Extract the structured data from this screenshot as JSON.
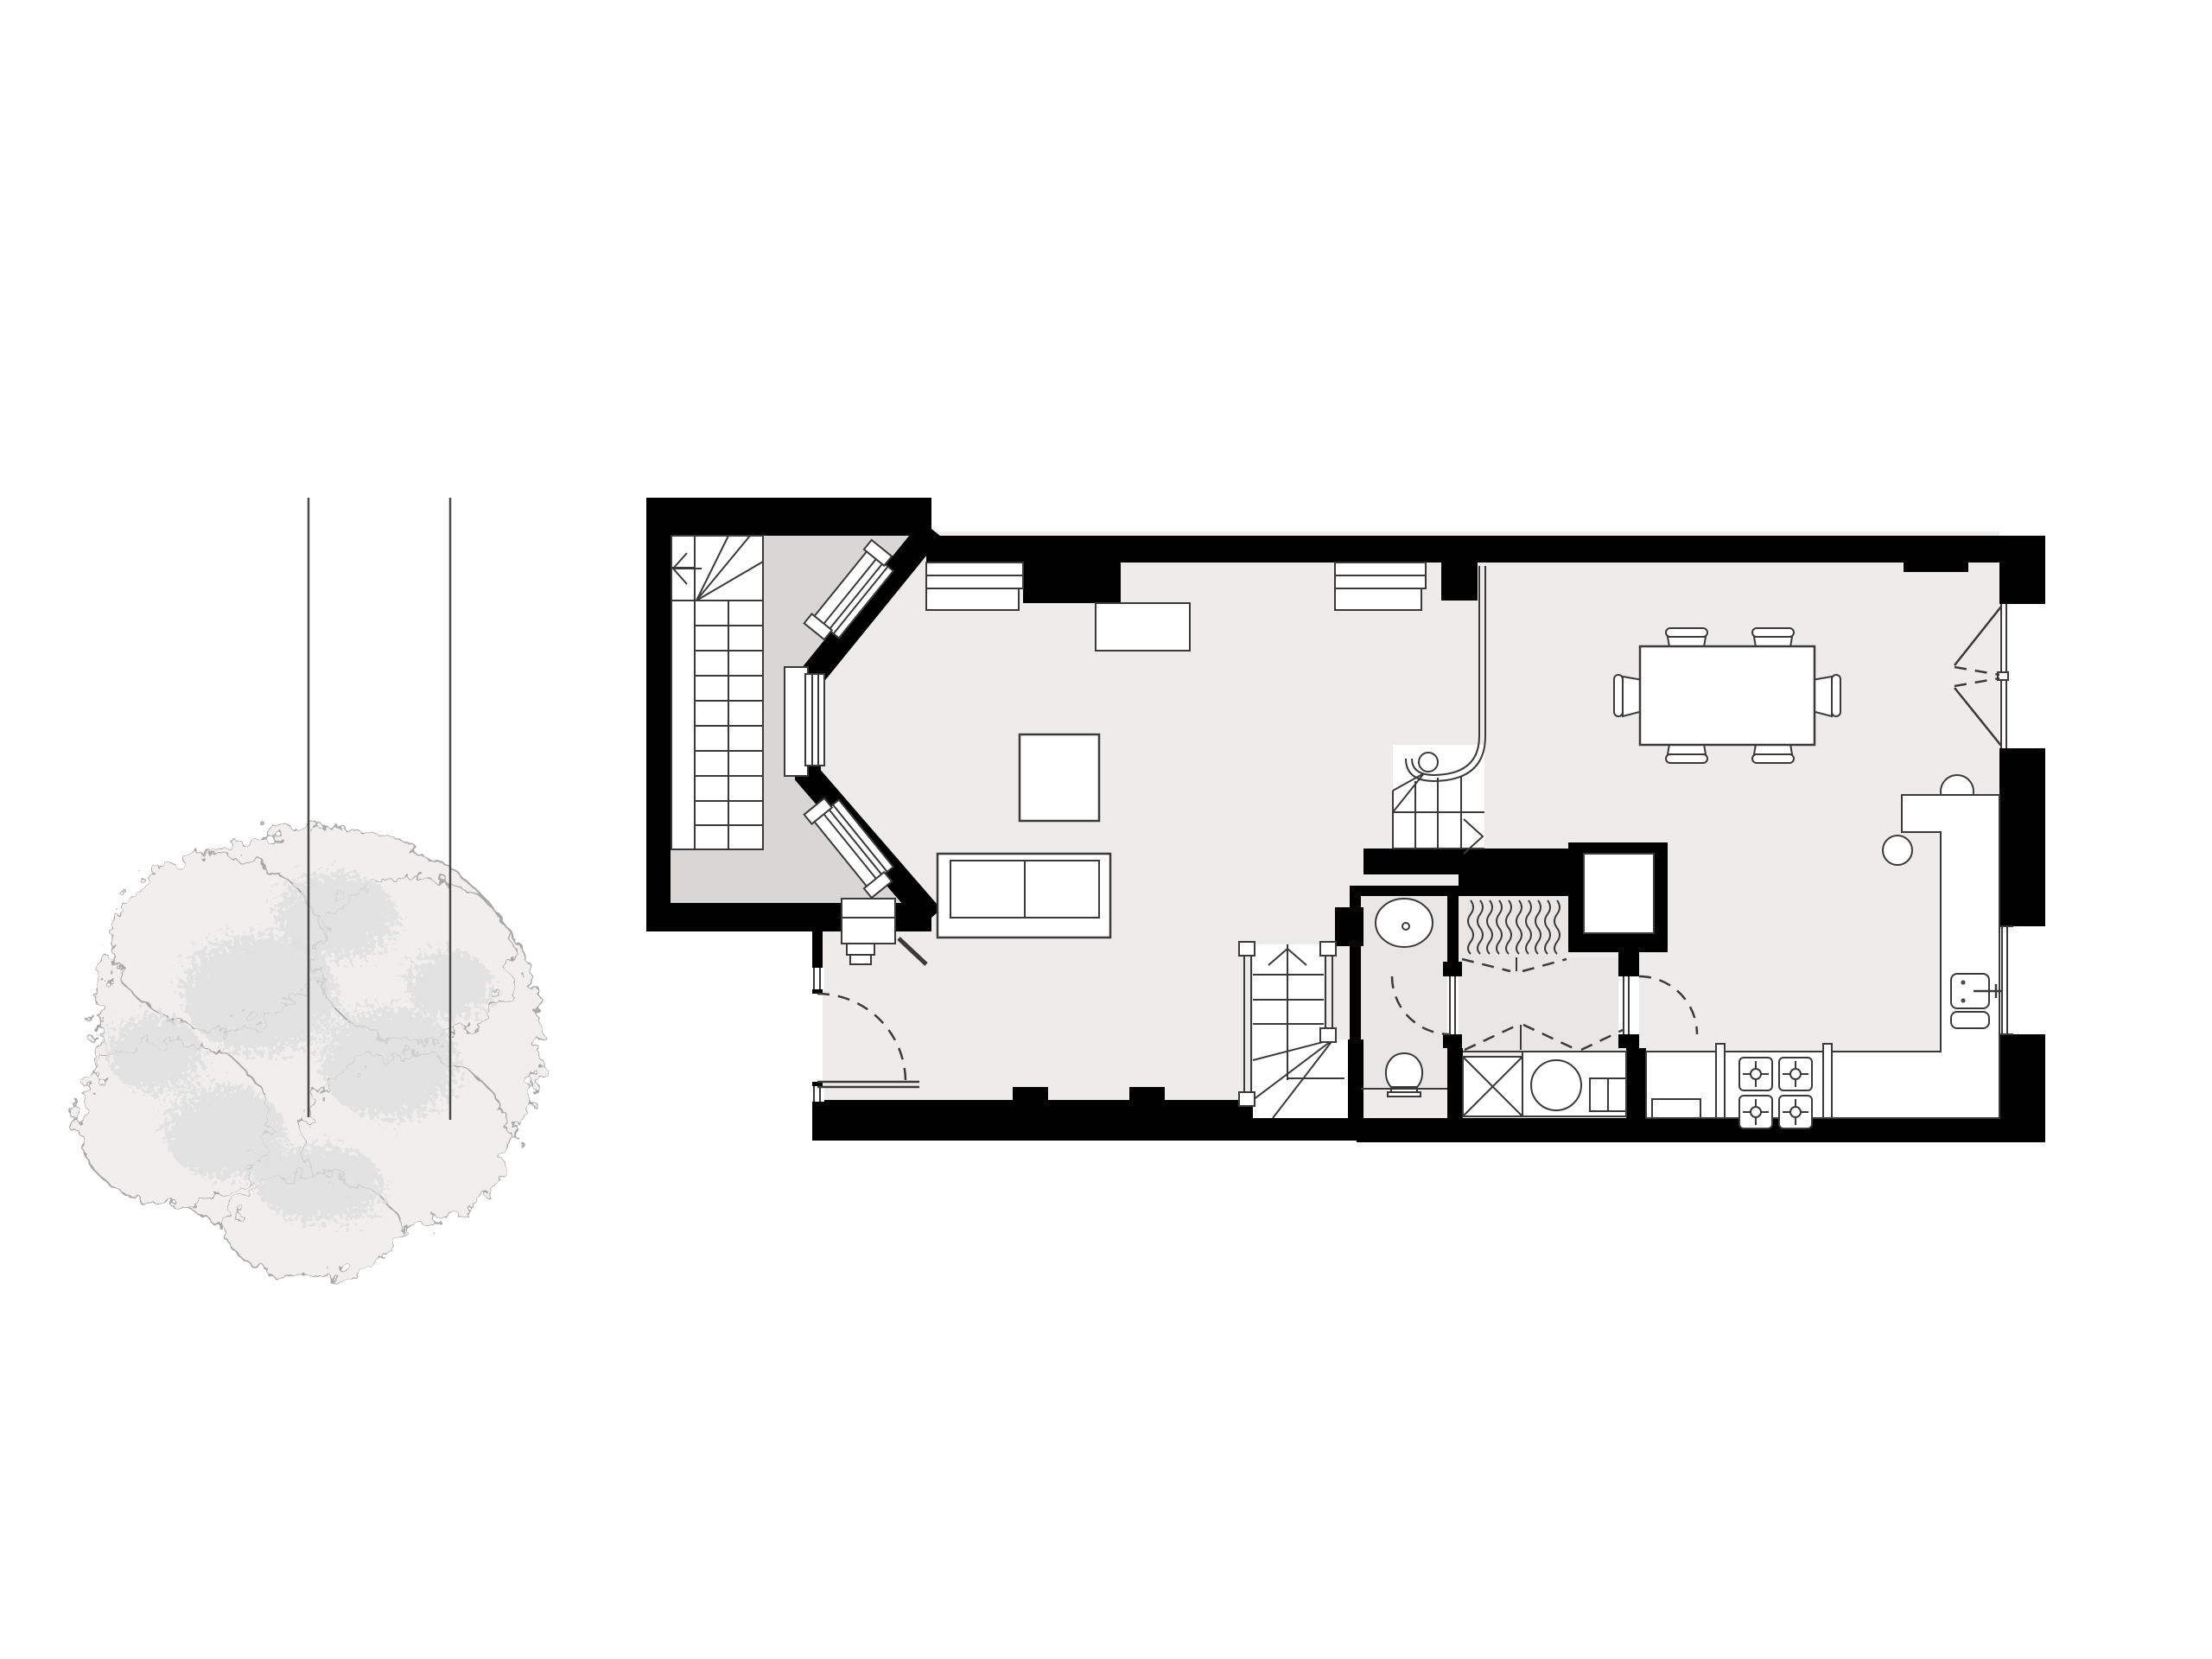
{
  "document": {
    "type": "architectural-floor-plan",
    "level": "ground floor",
    "drawing_style": "black poche walls, white fixtures, gray floor tints",
    "visible_text": "none"
  },
  "colors": {
    "wall": "#000000",
    "line": "#3a3a3a",
    "floor_main": "#edecea",
    "floor_hall": "#d8d7d5",
    "floor_wet": "#e8e7e5",
    "white": "#ffffff",
    "tree_fill": "#f0efee",
    "tree_edge": "#a9a9a9",
    "tree_mottle": "#dededd",
    "boundary": "#4a4a4a",
    "bg": "#ffffff"
  },
  "site": {
    "tree": {
      "shape": "plan-view canopy blob",
      "position": "left of plan",
      "texture": "mottled light gray"
    },
    "boundary_lines": {
      "count": 2,
      "orientation": "vertical",
      "through": "tree canopy"
    }
  },
  "rooms": [
    {
      "name": "entrance-stair-hall",
      "floor": "gray",
      "contents": [
        "long straight stair with top winders",
        "direction arrow",
        "entrance porch with steps"
      ]
    },
    {
      "name": "living-area",
      "contents": [
        "sofa (2 cushions)",
        "coffee table",
        "canted bay window (3 lights)",
        "front window",
        "fireplace hearth",
        "front entrance door"
      ]
    },
    {
      "name": "dining-area",
      "contents": [
        "table with 6 chairs",
        "french doors to outside",
        "front window"
      ]
    },
    {
      "name": "kitchen",
      "contents": [
        "L-shaped peninsula with 2 stools",
        "sink with tap",
        "4-burner hob",
        "base counters",
        "side window"
      ]
    },
    {
      "name": "wc",
      "floor": "wet-gray",
      "contents": [
        "oval basin",
        "toilet",
        "inward swing door"
      ]
    },
    {
      "name": "coat-closet",
      "contents": [
        "10 hanging coats (wavy symbol)",
        "bifold doors (dashed)"
      ]
    },
    {
      "name": "utility-cupboard",
      "contents": [
        "crossed shelf box",
        "washing machine (drum + drawer)",
        "dashed double doors"
      ]
    }
  ],
  "stairs": [
    {
      "name": "hall-stair",
      "treads": 11,
      "winders": 4,
      "arrow": "up-left"
    },
    {
      "name": "main-stair",
      "treads": 4,
      "feature": "curved volute balustrade to front wall",
      "arrow": "chevron-right"
    },
    {
      "name": "basement-stair",
      "treads": 3,
      "winders": 4,
      "arrow": "up",
      "rails": 2
    }
  ],
  "openings": {
    "bay_window_lights": 3,
    "front_windows": 2,
    "french_doors_leaves": 2,
    "side_window": 1,
    "right_window": 1,
    "sidelights_at_front_door": 2,
    "interior_doors": 3
  },
  "appliances": {
    "hob_burners": 4,
    "washing_machine": 1,
    "kitchen_sink_bowls": 2
  }
}
